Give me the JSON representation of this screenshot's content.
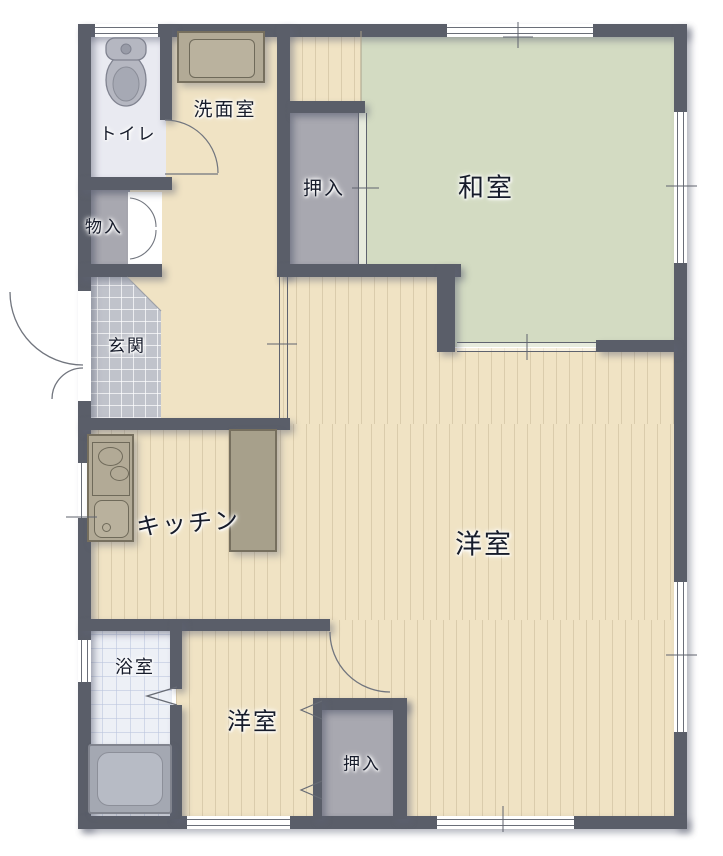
{
  "plan": {
    "type": "floor-plan",
    "labels": {
      "toilet": "トイレ",
      "washroom": "洗面室",
      "closet_north": "押入",
      "japanese_room": "和室",
      "storage": "物入",
      "entrance": "玄関",
      "kitchen": "キッチン",
      "western_room_main": "洋室",
      "bathroom": "浴室",
      "western_room_south": "洋室",
      "closet_south": "押入"
    },
    "fixtures": [
      "toilet-bowl",
      "vanity-sink",
      "kitchen-stove-sink",
      "kitchen-counter",
      "bathtub"
    ],
    "colors": {
      "wall": "#5a5e69",
      "wood_floor": "#f0e3c4",
      "tatami_floor": "#d3dbc2",
      "toilet_floor": "#e9eaf1",
      "bath_tile": "#edf0f6",
      "entry_tile": "#c0c3cb",
      "closet_floor": "#a8a8b0",
      "counter": "#b2aa96",
      "fixture_gray": "#b5b7c1",
      "label_text": "#171c2b"
    }
  }
}
